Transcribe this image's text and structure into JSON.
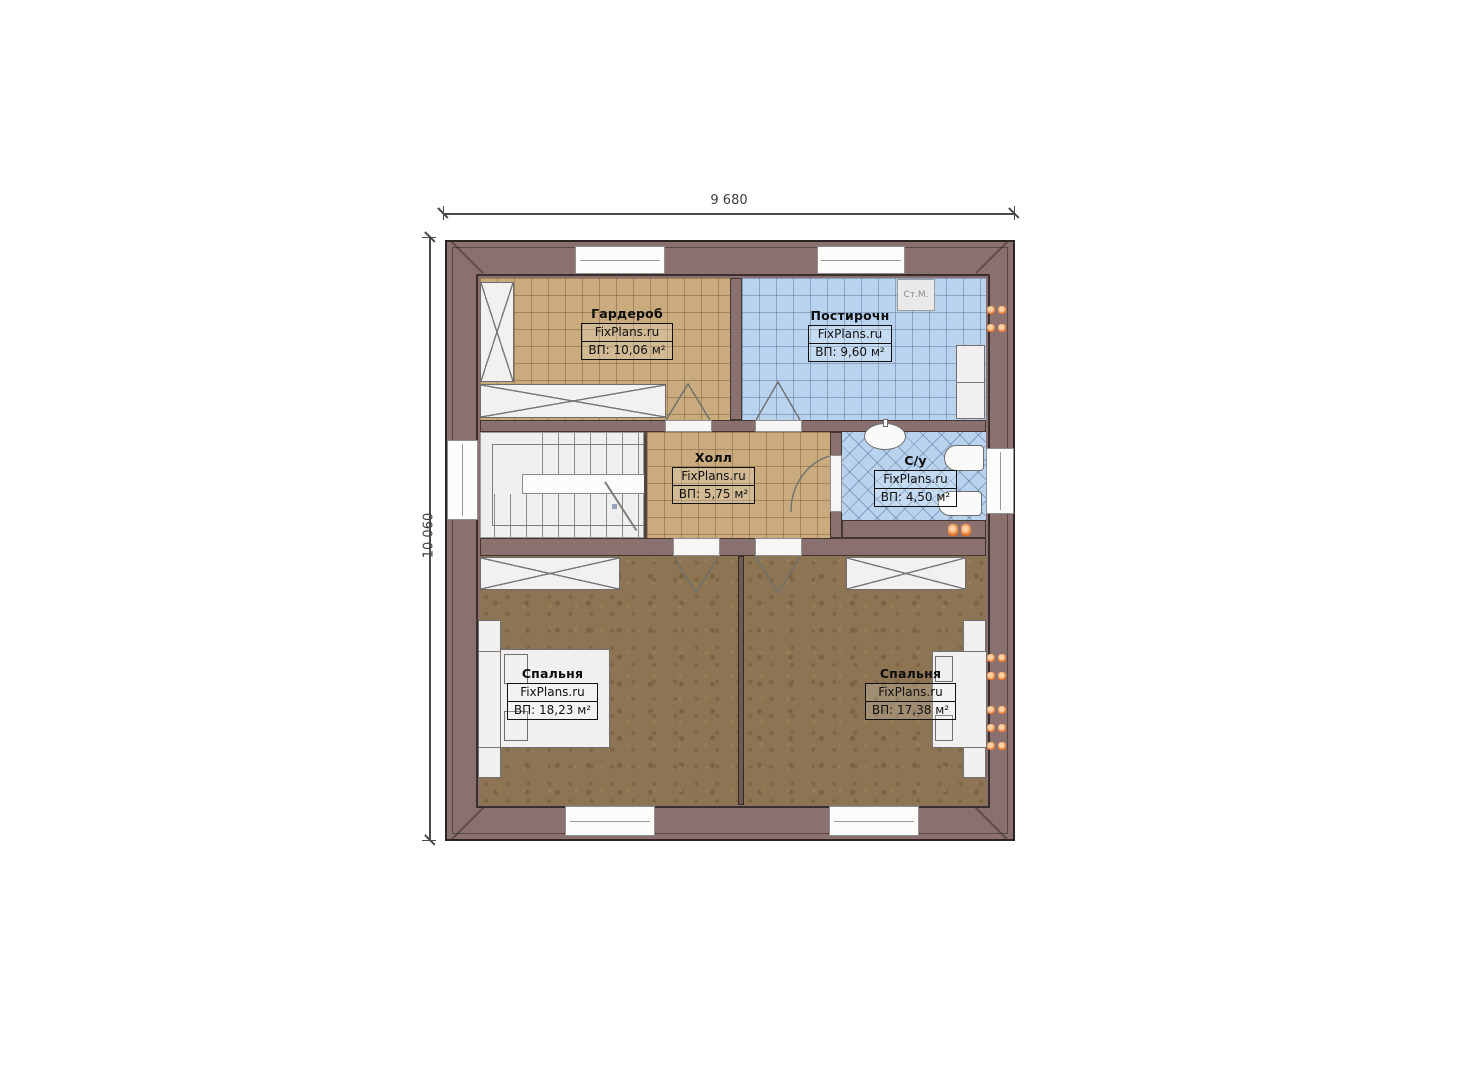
{
  "plan": {
    "dimensions": {
      "width_label": "9 680",
      "height_label": "10 060"
    },
    "brand": "FixPlans.ru",
    "rooms": [
      {
        "id": "wardrobe",
        "name": "Гардероб",
        "brand": "FixPlans.ru",
        "area": "ВП: 10,06 м²"
      },
      {
        "id": "laundry",
        "name": "Постирочн",
        "brand": "FixPlans.ru",
        "area": "ВП: 9,60 м²"
      },
      {
        "id": "hall",
        "name": "Холл",
        "brand": "FixPlans.ru",
        "area": "ВП: 5,75 м²"
      },
      {
        "id": "bathroom",
        "name": "С/у",
        "brand": "FixPlans.ru",
        "area": "ВП: 4,50 м²"
      },
      {
        "id": "bedroom-left",
        "name": "Спальня",
        "brand": "FixPlans.ru",
        "area": "ВП: 18,23 м²"
      },
      {
        "id": "bedroom-right",
        "name": "Спальня",
        "brand": "FixPlans.ru",
        "area": "ВП: 17,38 м²"
      }
    ],
    "appliances": [
      {
        "id": "washing-machine",
        "label": "Ст.М."
      }
    ],
    "colors": {
      "wall": "#8a7170",
      "tile_tan": "#c9ab7e",
      "tile_blue": "#b9d3ee",
      "carpet": "#8d7452",
      "radiator": "#e8762a",
      "furniture": "#f1f0ee"
    }
  }
}
